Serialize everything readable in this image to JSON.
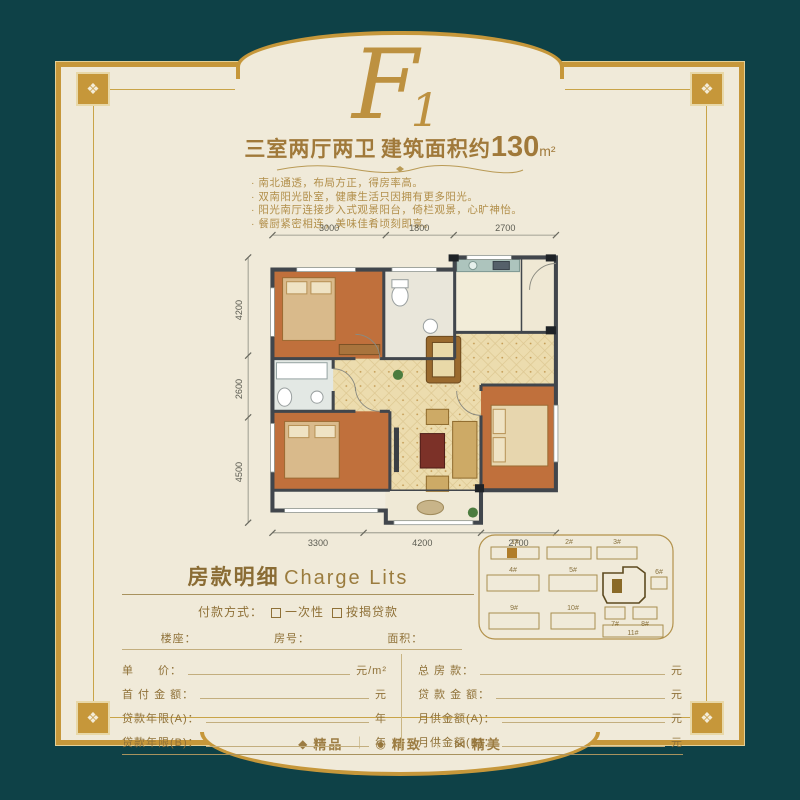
{
  "logo": {
    "letter": "F",
    "number": "1"
  },
  "header": {
    "rooms": "三室两厅两卫",
    "area_prefix": "建筑面积约",
    "area_value": "130",
    "area_unit": "m²"
  },
  "features": [
    "· 南北通透，布局方正，得房率高。",
    "· 双南阳光卧室，健康生活只因拥有更多阳光。",
    "· 阳光南厅连接步入式观景阳台，倚栏观景，心旷神怡。",
    "· 餐厨紧密相连，美味佳肴顷刻即享。"
  ],
  "floorplan": {
    "dims_top": [
      "3000",
      "1800",
      "2700"
    ],
    "dims_left": [
      "4200",
      "2600",
      "4500"
    ],
    "dims_bottom": [
      "3300",
      "4200",
      "2700"
    ]
  },
  "charge": {
    "title_zh": "房款明细",
    "title_en": "Charge Lits",
    "payment_label": "付款方式：",
    "option_a": "一次性",
    "option_b": "按揭贷款",
    "field_building": "楼座：",
    "field_room": "房号：",
    "field_area": "面积：",
    "rows_left": [
      {
        "label": "单　　价：",
        "unit": "元/m²"
      },
      {
        "label": "首 付 金 额：",
        "unit": "元"
      },
      {
        "label": "贷款年限(A)：",
        "unit": "年"
      },
      {
        "label": "贷款年限(B)：",
        "unit": "年"
      }
    ],
    "rows_right": [
      {
        "label": "总  房  款：",
        "unit": "元"
      },
      {
        "label": "贷 款 金 额：",
        "unit": "元"
      },
      {
        "label": "月供金额(A)：",
        "unit": "元"
      },
      {
        "label": "月供金额(B)：",
        "unit": "元"
      }
    ]
  },
  "keymap": {
    "labels": [
      "1#",
      "2#",
      "3#",
      "4#",
      "5#",
      "6#",
      "7#",
      "8#",
      "9#",
      "10#",
      "11#"
    ]
  },
  "frame": {
    "ornament_glyph": "❖"
  },
  "footer": {
    "separator": "｜",
    "items": [
      {
        "glyph": "◆",
        "label": "精品"
      },
      {
        "glyph": "◉",
        "label": "精致"
      },
      {
        "glyph": "⋈",
        "label": "精美"
      }
    ]
  },
  "colors": {
    "background_teal": "#0e4147",
    "gold_border": "#c6973a",
    "card_cream": "#f0ead9",
    "title_brown": "#a0793a",
    "bedroom_floor": "#c0703c",
    "living_tile": "#ecdcae"
  }
}
